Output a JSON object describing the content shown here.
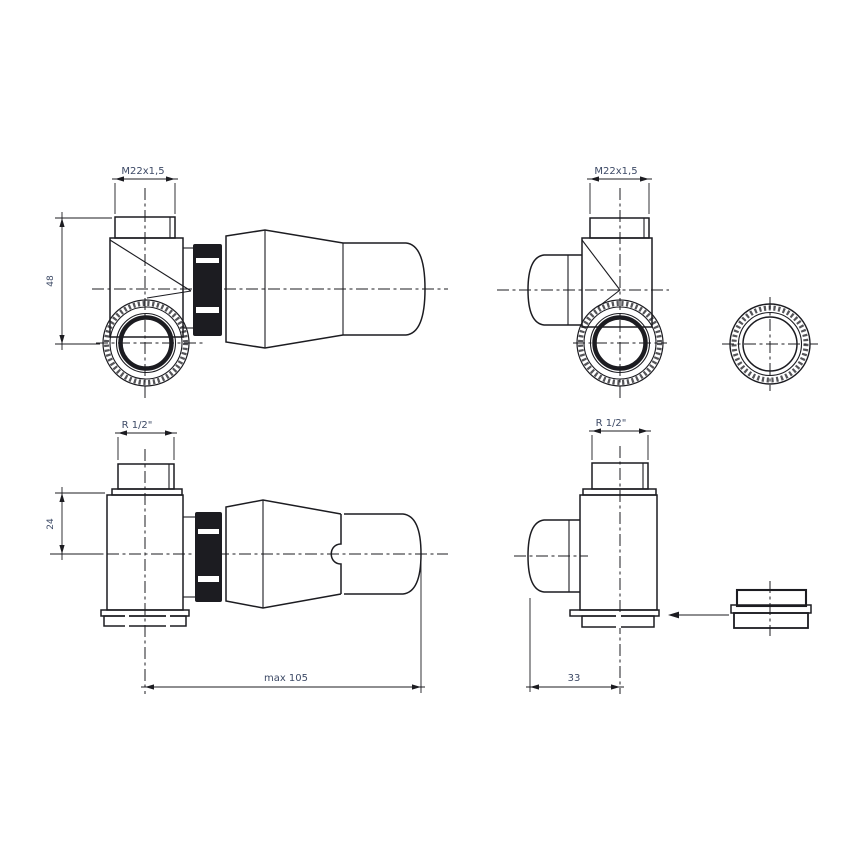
{
  "drawing": {
    "colors": {
      "ink": "#1c1c21",
      "dim_text": "#3d4a66",
      "background": "#ffffff"
    },
    "labels": {
      "m22_left": "M22x1,5",
      "m22_right": "M22x1,5",
      "dim_48": "48",
      "r_half_left": "R 1/2\"",
      "r_half_right": "R 1/2\"",
      "dim_24": "24",
      "dim_max105": "max 105",
      "dim_33": "33"
    }
  }
}
